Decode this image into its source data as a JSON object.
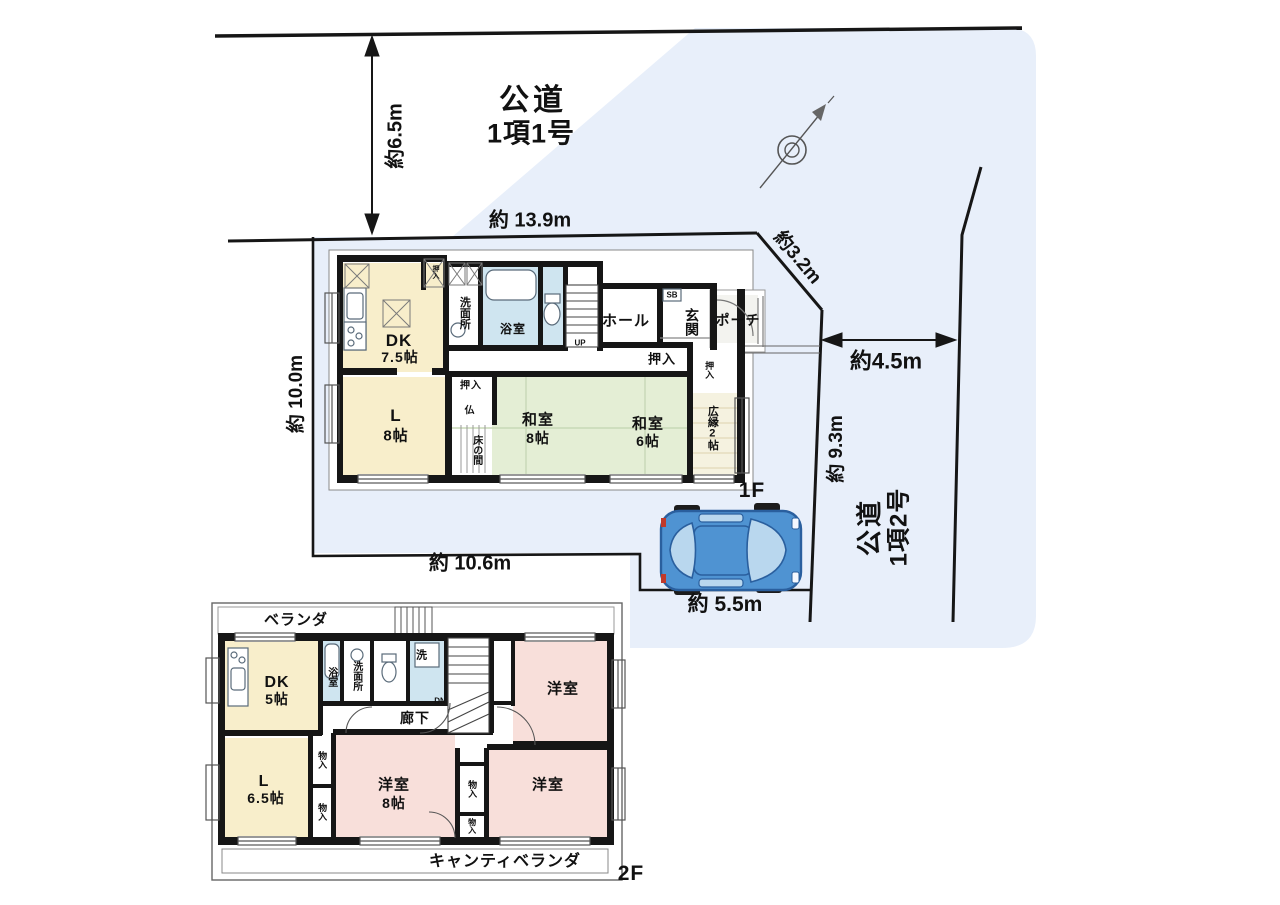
{
  "site": {
    "road_top_label": {
      "line1": "公道",
      "line2": "1項1号"
    },
    "road_right_label": {
      "line1": "公道",
      "line2": "1項2号"
    },
    "dim_top_vertical": "約6.5m",
    "dim_top_width": "約 13.9m",
    "dim_diagonal": "約3.2m",
    "dim_right_width": "約4.5m",
    "dim_right_depth": "約 9.3m",
    "dim_left_depth": "約 10.0m",
    "dim_bottom_width": "約 10.6m",
    "dim_parking": "約 5.5m"
  },
  "floor1": {
    "label": "1F",
    "dk_name": "DK",
    "dk_size": "7.5帖",
    "l_name": "L",
    "l_size": "8帖",
    "washitsu8_name": "和室",
    "washitsu8_size": "8帖",
    "washitsu6_name": "和室",
    "washitsu6_size": "6帖",
    "hiroen": "広縁2帖",
    "tokonoma": "床の間",
    "butsuma": "仏",
    "oshiire_center": "押入",
    "oshiire_washitsu6": "押入",
    "oshiire_hiroen": "押入",
    "oshiire_dk": "押入",
    "senmenjo": "洗面所",
    "yokushitsu": "浴室",
    "hall": "ホール",
    "genkan": "玄関",
    "porch": "ポーチ",
    "shoebox": "SB",
    "stairs_up": "UP"
  },
  "floor2": {
    "label": "2F",
    "veranda": "ベランダ",
    "cantilever_veranda": "キャンティベランダ",
    "dk_name": "DK",
    "dk_size": "5帖",
    "l_name": "L",
    "l_size": "6.5帖",
    "yokushitsu": "浴室",
    "senmenjo": "洗面所",
    "laundry": "洗",
    "corridor": "廊下",
    "yoshitsu_top": "洋室",
    "yoshitsu8_name": "洋室",
    "yoshitsu8_size": "8帖",
    "yoshitsu_right": "洋室",
    "monoire_1": "物入",
    "monoire_2": "物入",
    "monoire_3": "物入",
    "monoire_4": "物入",
    "stairs_dn": "DN"
  },
  "icons": {
    "car": "car-top-view",
    "compass": "north-compass"
  },
  "colors": {
    "site_bg": "#e8effa",
    "room_cream": "#f8eecb",
    "tatami_green": "#e4eed5",
    "room_pink": "#f8dfda",
    "bath_blue": "#cfe5f0",
    "wall": "#161616",
    "car_blue": "#4f93d2",
    "car_window": "#b9d7ee"
  }
}
